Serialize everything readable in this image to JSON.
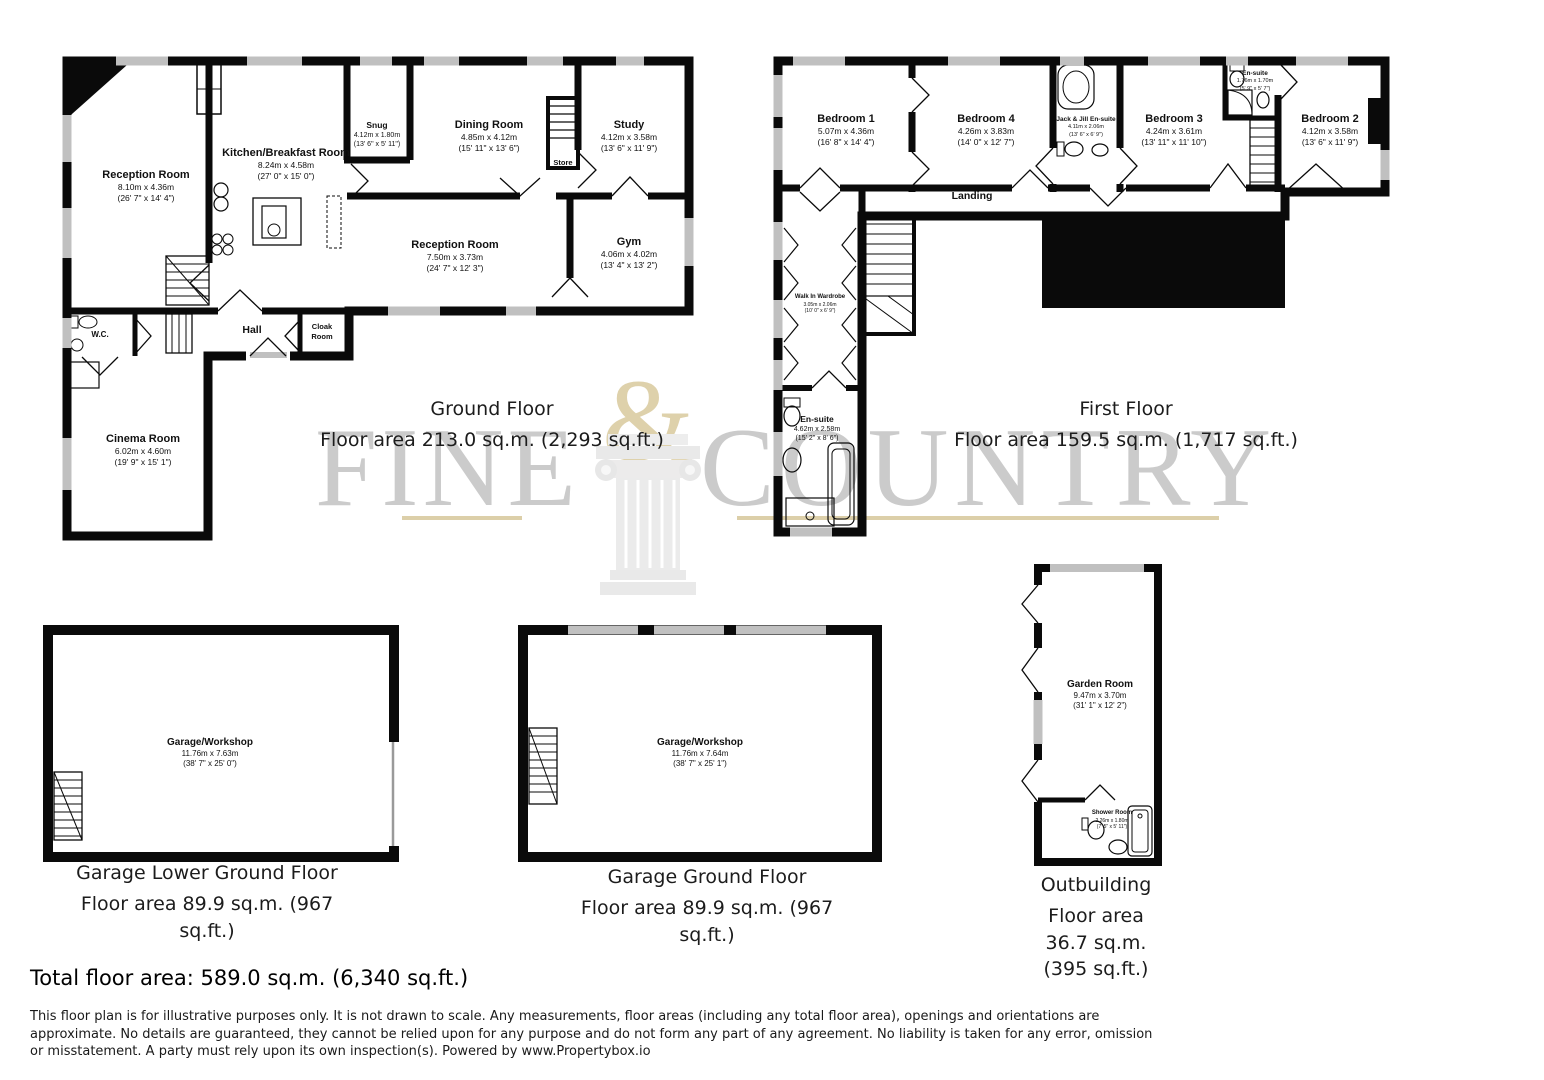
{
  "watermark": {
    "word_left": "FINE",
    "ampersand": "&",
    "word_right": "COUNTRY"
  },
  "ground_floor": {
    "title": "Ground Floor",
    "area_line": "Floor area 213.0 sq.m. (2,293 sq.ft.)",
    "rooms": {
      "reception_1": {
        "name": "Reception Room",
        "metric": "8.10m x 4.36m",
        "imperial": "(26' 7\" x 14' 4\")"
      },
      "kitchen": {
        "name": "Kitchen/Breakfast Room",
        "metric": "8.24m x 4.58m",
        "imperial": "(27' 0\" x 15' 0\")"
      },
      "snug": {
        "name": "Snug",
        "metric": "4.12m x 1.80m",
        "imperial": "(13' 6\" x 5' 11\")"
      },
      "dining": {
        "name": "Dining Room",
        "metric": "4.85m x 4.12m",
        "imperial": "(15' 11\" x 13' 6\")"
      },
      "study": {
        "name": "Study",
        "metric": "4.12m x 3.58m",
        "imperial": "(13' 6\" x 11' 9\")"
      },
      "store": {
        "name": "Store"
      },
      "reception_2": {
        "name": "Reception Room",
        "metric": "7.50m x 3.73m",
        "imperial": "(24' 7\" x 12' 3\")"
      },
      "gym": {
        "name": "Gym",
        "metric": "4.06m x 4.02m",
        "imperial": "(13' 4\" x 13' 2\")"
      },
      "wc": {
        "name": "W.C."
      },
      "hall": {
        "name": "Hall"
      },
      "cloak": {
        "name": "Cloak Room"
      },
      "cinema": {
        "name": "Cinema Room",
        "metric": "6.02m x 4.60m",
        "imperial": "(19' 9\" x 15' 1\")"
      }
    }
  },
  "first_floor": {
    "title": "First Floor",
    "area_line": "Floor area 159.5 sq.m. (1,717 sq.ft.)",
    "rooms": {
      "bedroom_1": {
        "name": "Bedroom 1",
        "metric": "5.07m x 4.36m",
        "imperial": "(16' 8\" x 14' 4\")"
      },
      "bedroom_4": {
        "name": "Bedroom 4",
        "metric": "4.26m x 3.83m",
        "imperial": "(14' 0\" x 12' 7\")"
      },
      "jack_jill": {
        "name": "Jack & Jill En-suite",
        "metric": "4.11m x 2.06m",
        "imperial": "(13' 6\" x 6' 9\")"
      },
      "bedroom_3": {
        "name": "Bedroom 3",
        "metric": "4.24m x 3.61m",
        "imperial": "(13' 11\" x 11' 10\")"
      },
      "ensuite_top": {
        "name": "En-suite",
        "metric": "1.76m x 1.70m",
        "imperial": "(5' 9\" x 5' 7\")"
      },
      "bedroom_2": {
        "name": "Bedroom 2",
        "metric": "4.12m x 3.58m",
        "imperial": "(13' 6\" x 11' 9\")"
      },
      "landing": {
        "name": "Landing"
      },
      "wardrobe": {
        "name": "Walk In Wardrobe",
        "metric": "3.05m x 2.06m",
        "imperial": "(10' 0\" x 6' 9\")"
      },
      "ensuite_main": {
        "name": "En-suite",
        "metric": "4.62m x 2.58m",
        "imperial": "(15' 2\" x 8' 6\")"
      }
    }
  },
  "garage_lower": {
    "title": "Garage Lower Ground Floor",
    "area_line": "Floor area 89.9 sq.m. (967 sq.ft.)",
    "room": {
      "name": "Garage/Workshop",
      "metric": "11.76m x 7.63m",
      "imperial": "(38' 7\" x 25' 0\")"
    }
  },
  "garage_ground": {
    "title": "Garage Ground Floor",
    "area_line": "Floor area 89.9 sq.m. (967 sq.ft.)",
    "room": {
      "name": "Garage/Workshop",
      "metric": "11.76m x 7.64m",
      "imperial": "(38' 7\" x 25' 1\")"
    }
  },
  "outbuilding": {
    "title": "Outbuilding",
    "area_line": "Floor area 36.7 sq.m. (395 sq.ft.)",
    "rooms": {
      "garden": {
        "name": "Garden Room",
        "metric": "9.47m x 3.70m",
        "imperial": "(31' 1\" x 12' 2\")"
      },
      "shower": {
        "name": "Shower Room",
        "metric": "2.26m x 1.80m",
        "imperial": "(7' 5\" x 5' 11\")"
      }
    }
  },
  "totals": {
    "total_line": "Total floor area: 589.0 sq.m. (6,340 sq.ft.)"
  },
  "disclaimer": "This floor plan is for illustrative purposes only. It is not drawn to scale. Any measurements, floor areas (including any total floor area), openings and orientations are approximate. No details are guaranteed, they cannot be relied upon for any purpose and do not form any part of any agreement. No liability is taken for any error, omission or misstatement. A party must rely upon its own inspection(s). Powered by www.Propertybox.io",
  "colors": {
    "wall": "#0a0a0a",
    "window": "#c0c0c0",
    "watermark_gray": "#cbcbcb",
    "watermark_beige": "#ded1ab",
    "text": "#111111"
  }
}
